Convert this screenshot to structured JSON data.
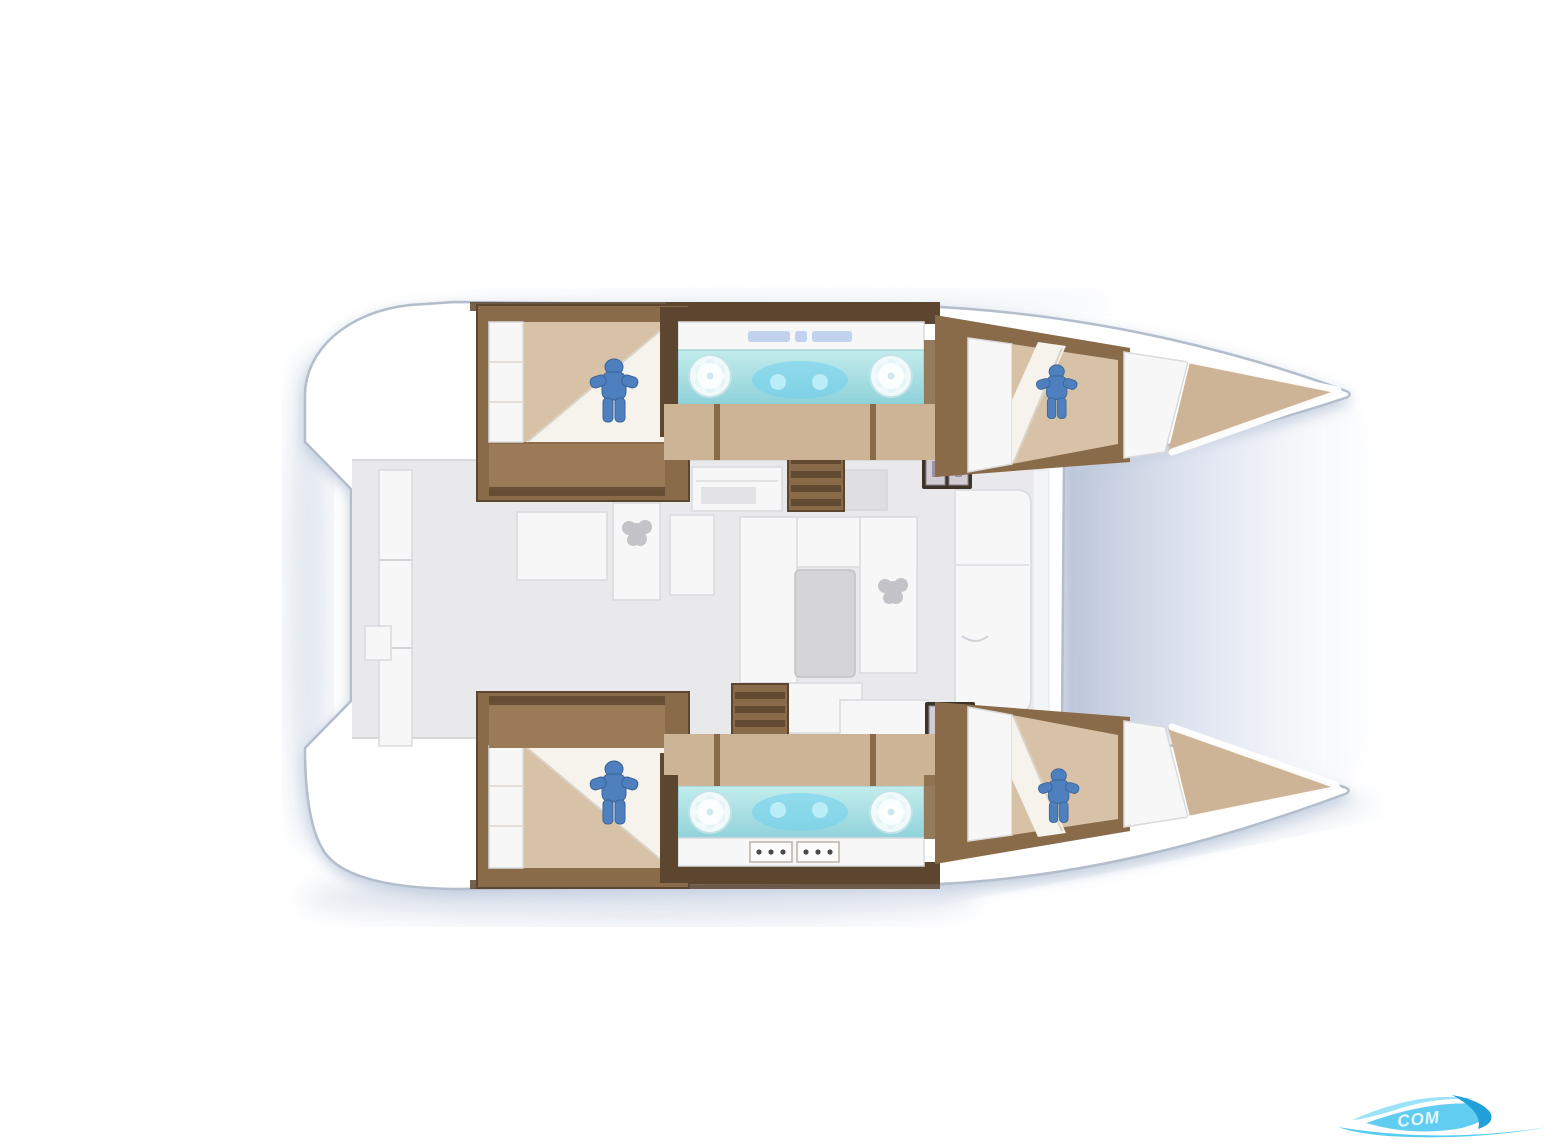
{
  "page": {
    "background": "#ffffff",
    "description": "Top-down interior layout plan of a sailing catamaran: four double cabins with blue occupant figures, two teal head/galley counters with round sinks, central saloon with dinette table and companionway stairs, twin bows pointing right, aft cockpit notch at left, cyan swoosh watermark at bottom right"
  },
  "palette": {
    "hull_fill": "#ffffff",
    "hull_stroke": "#b3bdcc",
    "shadow_blue": "#c6d1e2",
    "wood": "#8a6b49",
    "wood_dark": "#5d4630",
    "wood_mid": "#9b7b57",
    "floor_tan": "#cdb496",
    "bed_tan": "#d7c2a8",
    "linen_white": "#f6f3ec",
    "salon_floor": "#e9e9ec",
    "furniture_white": "#f7f7f8",
    "furniture_border": "#d9dadd",
    "table_gray": "#d5d5d8",
    "plant_gray": "#c4c4c8",
    "counter_teal": "#a9dde0",
    "counter_teal_deep": "#74cde8",
    "sink_white": "#f0fafb",
    "figure_blue": "#4e7fbe",
    "hatch_dark": "#3e332a",
    "hatch_pane": "#d2cbd4",
    "text_smudge_blue": "#9db8e8",
    "watermark_cyan_light": "#8fe0f7",
    "watermark_cyan": "#45c6ee",
    "watermark_blue": "#219fd8"
  },
  "rooms": [
    {
      "id": "upper-aft-cabin",
      "type": "double-cabin",
      "occupant_marker": true
    },
    {
      "id": "upper-head",
      "type": "bathroom-counter-two-sinks"
    },
    {
      "id": "upper-forward-cabin",
      "type": "double-cabin",
      "occupant_marker": true
    },
    {
      "id": "lower-aft-cabin",
      "type": "double-cabin",
      "occupant_marker": true
    },
    {
      "id": "lower-head",
      "type": "bathroom-counter-two-sinks-stove"
    },
    {
      "id": "lower-forward-cabin",
      "type": "double-cabin",
      "occupant_marker": true
    },
    {
      "id": "saloon",
      "type": "saloon-dinette-table"
    },
    {
      "id": "cockpit",
      "type": "aft-cockpit-bench"
    }
  ],
  "watermark": {
    "text_fragment": "COM"
  }
}
